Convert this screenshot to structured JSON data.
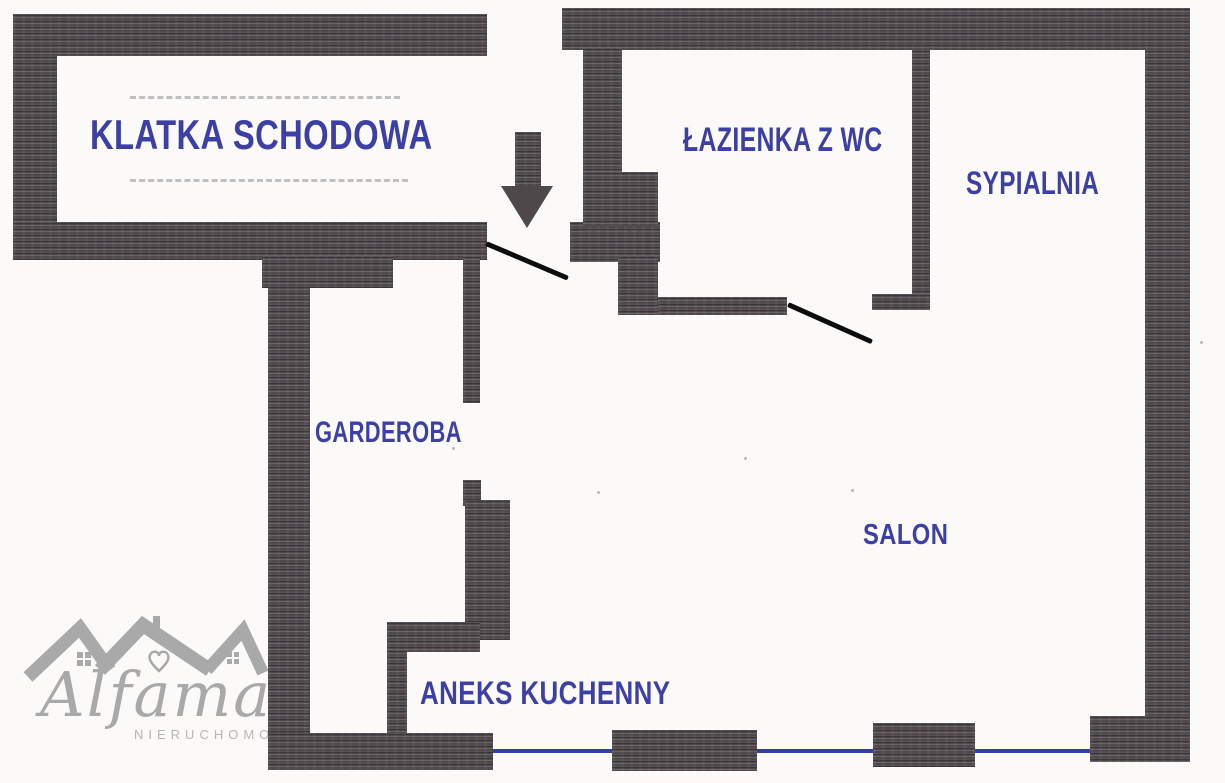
{
  "plan": {
    "rooms": [
      {
        "key": "klatka-schodowa",
        "label": "KLATKA SCHODOWA"
      },
      {
        "key": "lazienka-z-wc",
        "label": "ŁAZIENKA Z WC"
      },
      {
        "key": "sypialnia",
        "label": "SYPIALNIA"
      },
      {
        "key": "garderoba",
        "label": "GARDEROBA"
      },
      {
        "key": "salon",
        "label": "SALON"
      },
      {
        "key": "aneks-kuchenny",
        "label": "ANEKS KUCHENNY"
      }
    ],
    "entrance_arrow_icon": "down-arrow",
    "colors": {
      "background": "#fbfaf8",
      "wall": "#4e484b",
      "room_label": "#3b3fa6",
      "window_line": "#3540a2",
      "door_line": "#0d0d0d",
      "stair_dash": "#8f8f94",
      "logo_gray": "#a9a9a9"
    }
  },
  "watermark": {
    "brand": "Alfama",
    "subtitle": "NIERUCHOMOŚCI"
  }
}
